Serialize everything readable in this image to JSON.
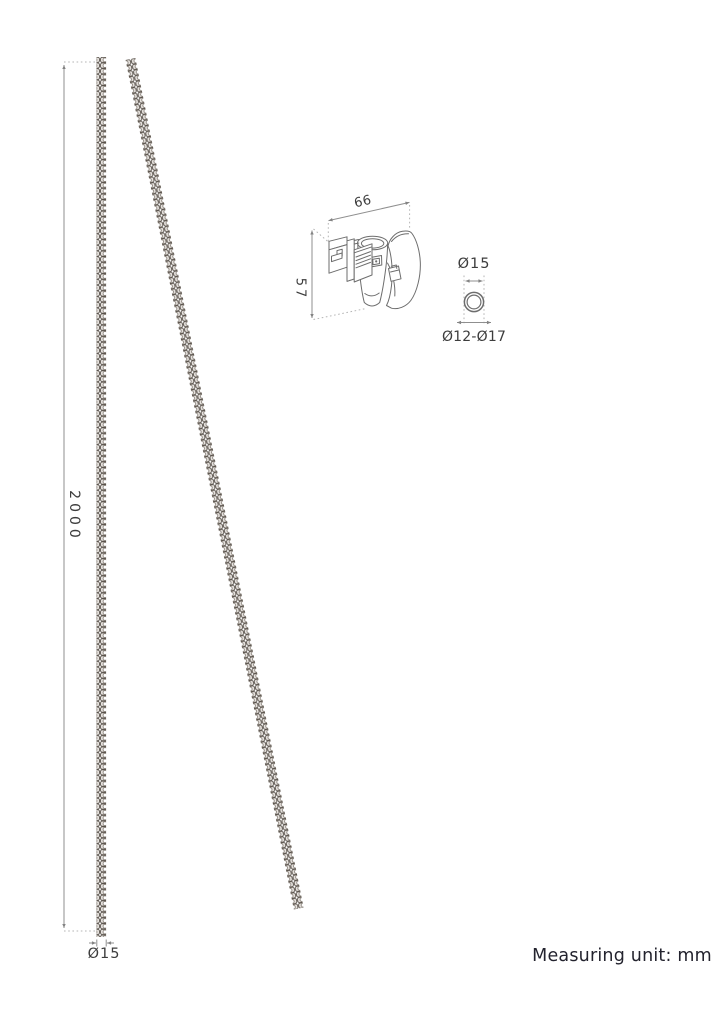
{
  "footer": {
    "text": "Measuring unit: mm"
  },
  "drawing": {
    "dimensions": {
      "chain_length": "2000",
      "chain_diameter": "Ø15",
      "bracket_width": "66",
      "bracket_height": "57",
      "ring_outer_diameter": "Ø15",
      "ring_clamp_range": "Ø12-Ø17"
    }
  },
  "colors": {
    "background": "#ffffff",
    "line": "#6d6d6d",
    "dim": "#8f8f8f",
    "dot": "#b5b5b5",
    "dim_text": "#3d3d3d",
    "footer_text": "#23232e",
    "chain_outline": "#58514a",
    "chain_fill": "#e7e3df"
  }
}
